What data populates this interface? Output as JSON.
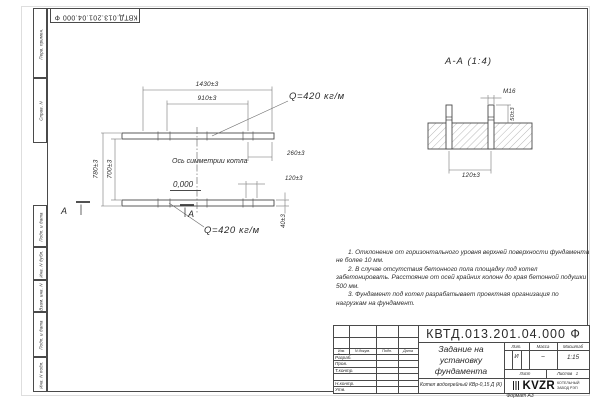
{
  "colors": {
    "ink": "#4a4a4a",
    "paper": "#ffffff"
  },
  "corner_stamp": {
    "doc_number": "КВТД.013.201.04.000 Ф"
  },
  "frame_columns": {
    "top": [
      {
        "label": "Перв. примен."
      },
      {
        "label": "Справ. N"
      }
    ],
    "bottom": [
      {
        "label": "Подп. и дата"
      },
      {
        "label": "Инв. N дубл."
      },
      {
        "label": "Взам. инв. N"
      },
      {
        "label": "Подп. и дата"
      },
      {
        "label": "Инв. N подл."
      }
    ]
  },
  "plan": {
    "dim_1430": "1430±3",
    "dim_910": "910±3",
    "dim_780": "780±3",
    "dim_700": "700±3",
    "dim_260": "260±3",
    "dim_120": "120±3",
    "dim_40": "40±3",
    "axis_label": "Ось симметрии котла",
    "elevation": "0,000",
    "load_top": "Q=420 кг/м",
    "load_bottom": "Q=420 кг/м",
    "section_mark_left": "А",
    "section_mark_right": "А"
  },
  "section": {
    "title": "А-А (1:4)",
    "thread": "М16",
    "dim_50": "50±3",
    "dim_120": "120±3"
  },
  "notes": {
    "item1": "1. Отклонение от горизонтального уровня верхней поверхности фундамента не более 10 мм.",
    "item2": "2. В случае отсутствия бетонного пола площадку под котел забетонировать. Расстояние от осей крайних колонн до края бетонной подушки 500 мм.",
    "item3": "3. Фундамент под котел разрабатывает проектная организация по нагрузкам на фундамент."
  },
  "title_block": {
    "doc_number": "КВТД.013.201.04.000 Ф",
    "title_line1": "Задание на",
    "title_line2": "установку",
    "title_line3": "фундамента",
    "product": "Котел водогрейный КВр-0,15 Д (К)",
    "col_izm": "Изм. Лист",
    "col_doc": "N докум.",
    "col_sign": "Подп.",
    "col_date": "Дата",
    "row_razrab": "Разраб.",
    "row_prov": "Пров.",
    "row_tkontr": "Т.контр.",
    "row_nkontr": "Н.контр.",
    "row_utv": "Утв.",
    "lit_label": "Лит.",
    "lit_value": "И",
    "mass_label": "Масса",
    "mass_value": "–",
    "scale_label": "Масштаб",
    "scale_value": "1:15",
    "sheet_label": "Лист",
    "sheets_label": "Листов",
    "sheets_value": "1",
    "logo_text": "KVZR",
    "logo_caption_1": "КОТЕЛЬНЫЙ",
    "logo_caption_2": "ЗАВОД РЭП"
  },
  "footer": {
    "format_note": "Формат А3"
  }
}
